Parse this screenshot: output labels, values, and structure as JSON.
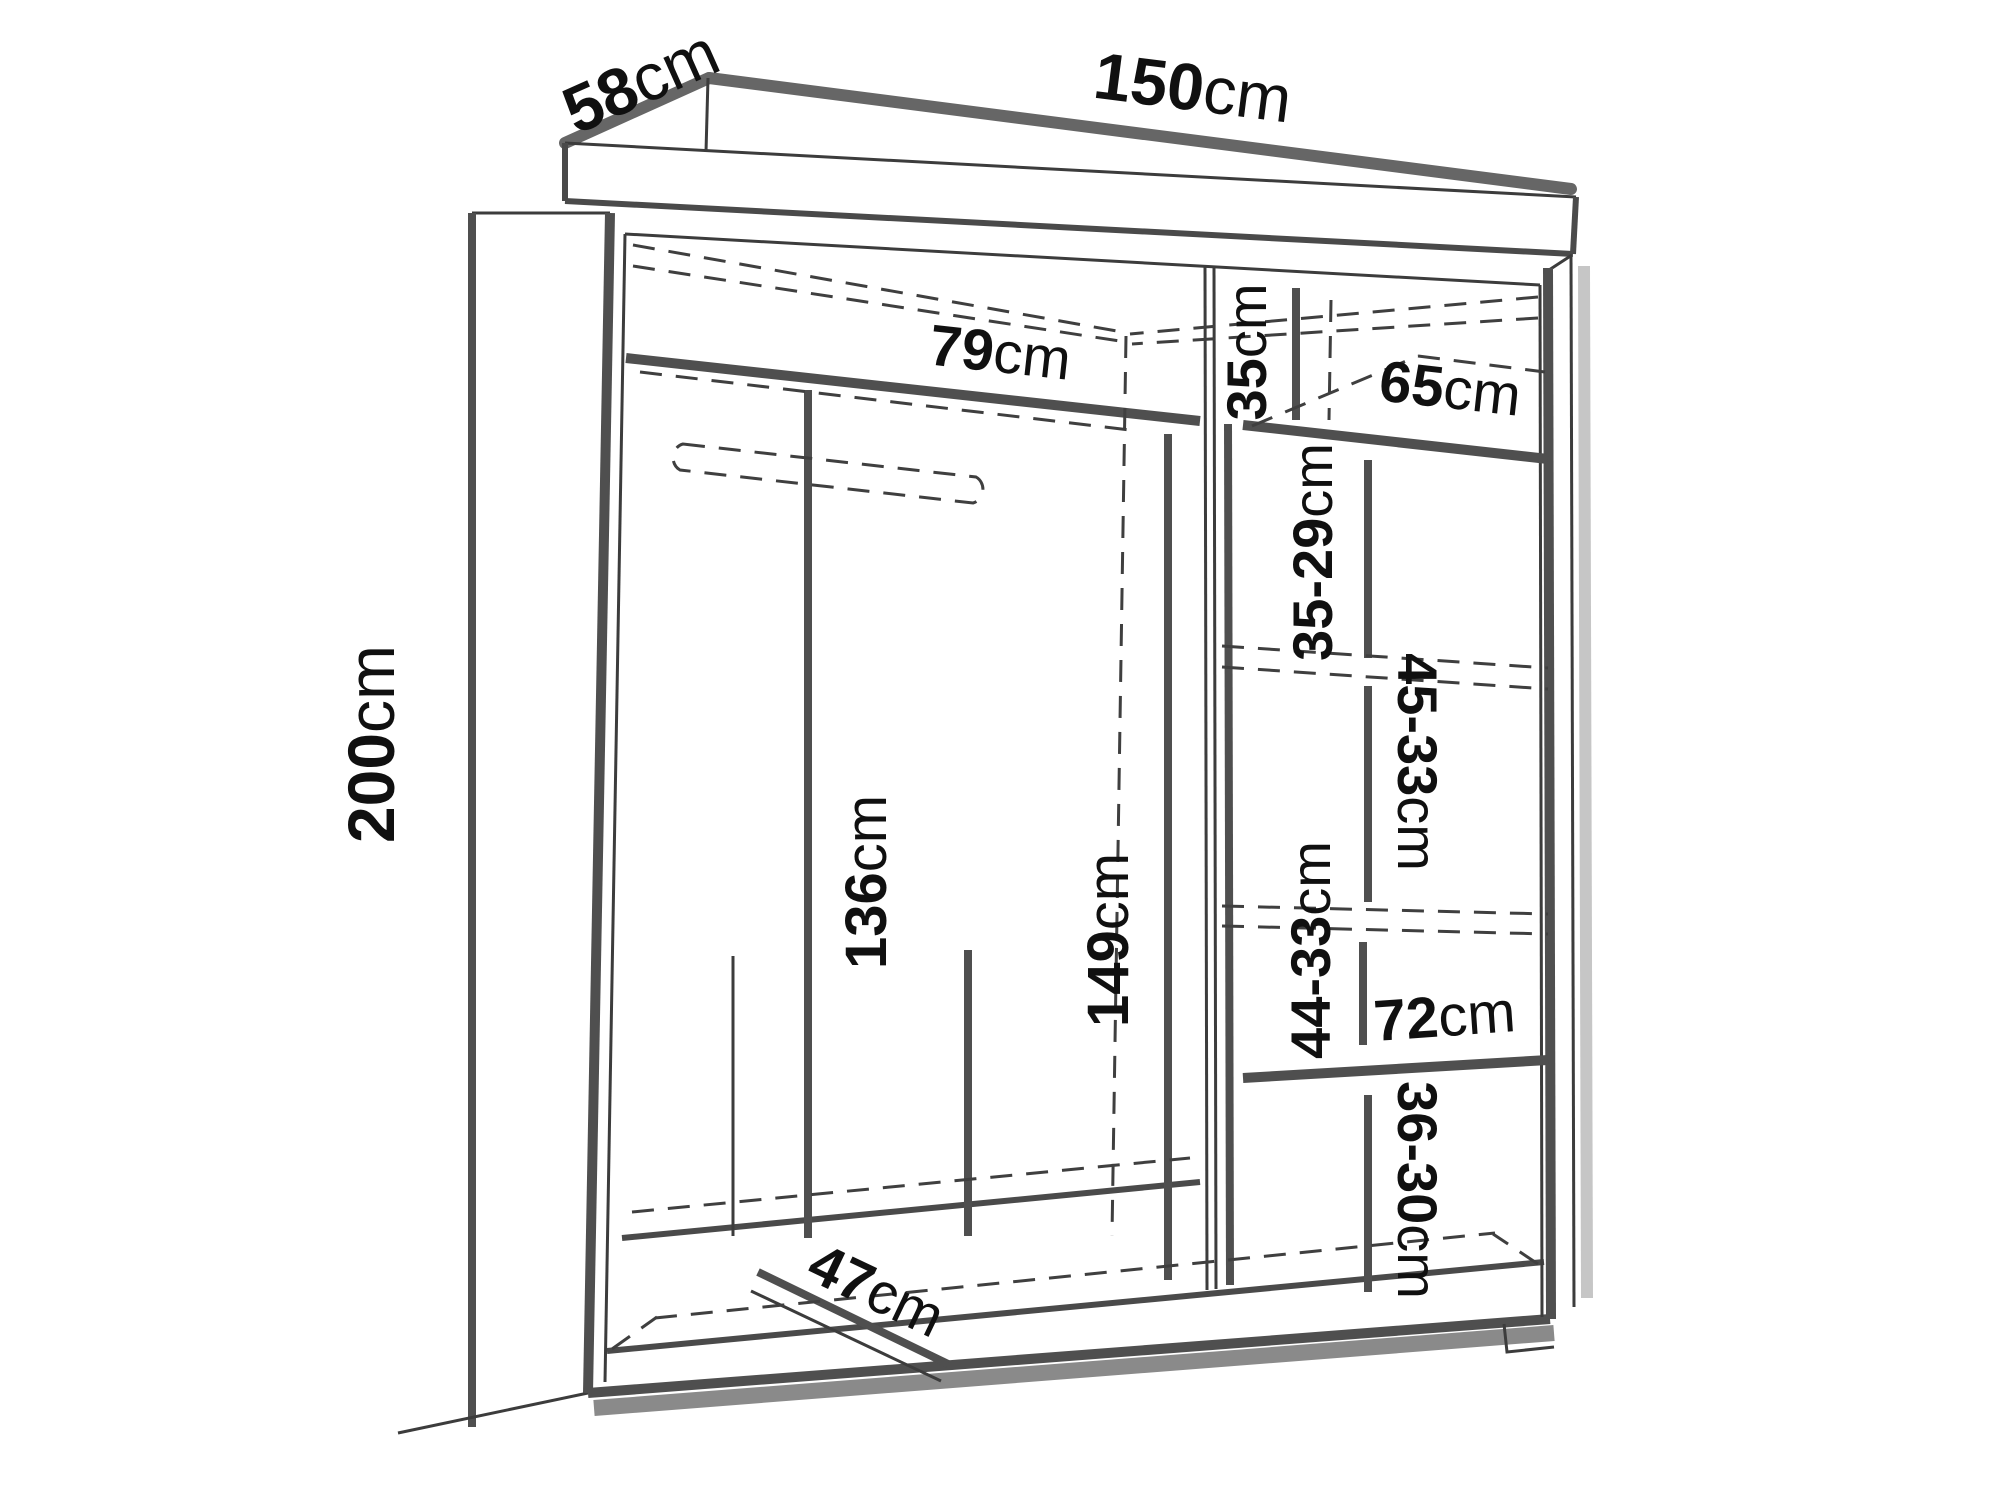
{
  "colors": {
    "background": "#ffffff",
    "line": "#4f4f4f",
    "dashed_line": "#3f3f3f",
    "shadow": "#8a8a8a",
    "text": "#101010"
  },
  "labels": {
    "depth": {
      "num": "58",
      "unit": "cm"
    },
    "width": {
      "num": "150",
      "unit": "cm"
    },
    "height": {
      "num": "200",
      "unit": "cm"
    },
    "left_shelf_width": {
      "num": "79",
      "unit": "cm"
    },
    "top_right_height": {
      "num": "35",
      "unit": "cm"
    },
    "right_shelf_width": {
      "num": "65",
      "unit": "cm"
    },
    "right_gap_top": {
      "num": "35-29",
      "unit": "cm"
    },
    "right_gap_upper": {
      "num": "45-33",
      "unit": "cm"
    },
    "hanging_height": {
      "num": "136",
      "unit": "cm"
    },
    "middle_height": {
      "num": "149",
      "unit": "cm"
    },
    "right_gap_lower": {
      "num": "44-33",
      "unit": "cm"
    },
    "lower_shelf_width": {
      "num": "72",
      "unit": "cm"
    },
    "right_gap_bottom": {
      "num": "36-30",
      "unit": "cm"
    },
    "bottom_depth": {
      "num": "47",
      "unit": "cm"
    }
  }
}
